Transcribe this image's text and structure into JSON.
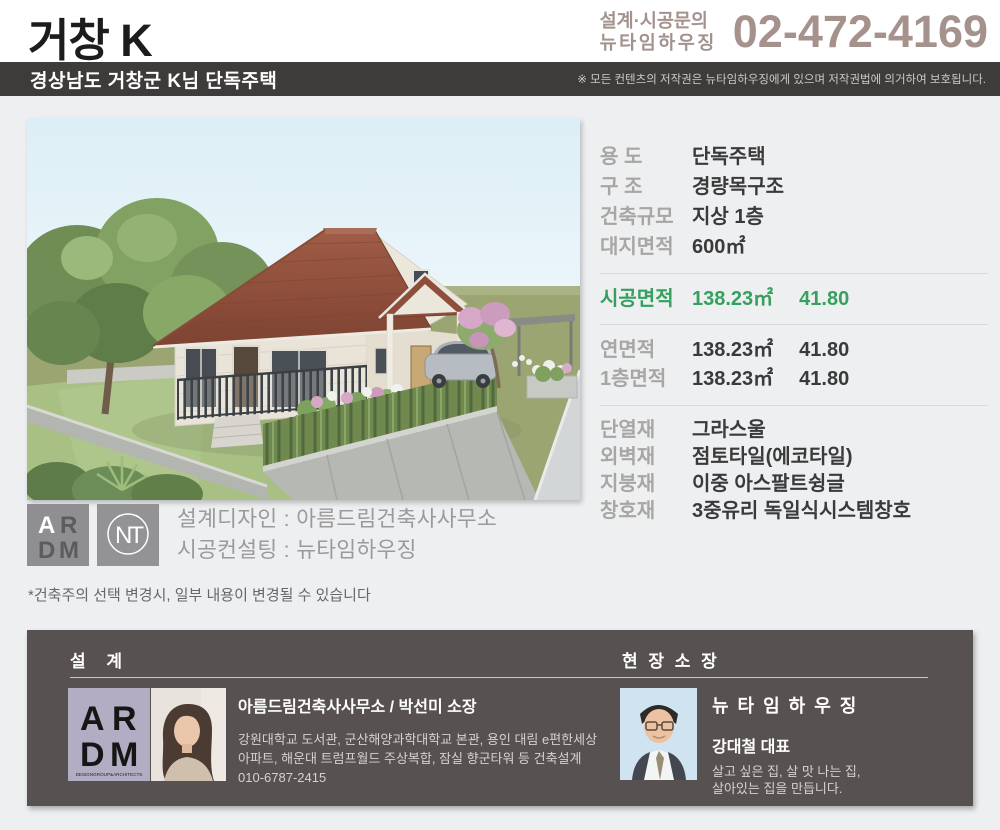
{
  "header": {
    "title": "거창 K",
    "contact_line1": "설계·시공문의",
    "contact_line2": "뉴타임하우징",
    "phone": "02-472-4169",
    "accent_color": "#a3928d"
  },
  "project_bar": {
    "title": "경상남도 거창군 K님 단독주택",
    "copyright": "※ 모든 컨텐츠의 저작권은 뉴타임하우징에게 있으며 저작권법에 의거하여 보호됩니다.",
    "bg_color": "#3e3b3b"
  },
  "specs": {
    "basic": [
      {
        "label": "용 도",
        "value": "단독주택"
      },
      {
        "label": "구 조",
        "value": "경량목구조"
      },
      {
        "label": "건축규모",
        "value": "지상 1층"
      },
      {
        "label": "대지면적",
        "value": "600㎡"
      }
    ],
    "construction": {
      "label": "시공면적",
      "value": "138.23㎡",
      "pyeong": "41.80",
      "color": "#36a05e"
    },
    "areas": [
      {
        "label": "연면적",
        "value": "138.23㎡",
        "pyeong": "41.80"
      },
      {
        "label": "1층면적",
        "value": "138.23㎡",
        "pyeong": "41.80"
      }
    ],
    "materials": [
      {
        "label": "단열재",
        "value": "그라스울"
      },
      {
        "label": "외벽재",
        "value": "점토타일(에코타일)"
      },
      {
        "label": "지붕재",
        "value": "이중 아스팔트슁글"
      },
      {
        "label": "창호재",
        "value": "3중유리 독일식시스템창호"
      }
    ]
  },
  "credits": {
    "design_line": "설계디자인 : 아름드림건축사사무소",
    "consulting_line": "시공컨설팅 : 뉴타임하우징",
    "note": "*건축주의 선택 변경시, 일부 내용이 변경될 수 있습니다"
  },
  "logos": {
    "adm_top_left": "A",
    "adm_top_right": "R",
    "adm_bottom_left": "D",
    "adm_bottom_right": "M",
    "nt_monogram": "NT"
  },
  "footer": {
    "design_section": {
      "heading": "설 계",
      "firm": "아름드림건축사사무소 / 박선미 소장",
      "desc_line1": "강원대학교 도서관, 군산해양과학대학교 본관, 용인 대림 e편한세상",
      "desc_line2": "아파트, 해운대 트럼프월드 주상복합, 잠실 향군타워 등 건축설계",
      "phone": "010-6787-2415",
      "logo_caption": "DESIGNGROUP&ARCHITECTS"
    },
    "site_manager_section": {
      "heading": "현 장 소 장",
      "company": "뉴 타 임 하 우 징",
      "name": "강대철 대표",
      "slogan_line1": "살고 싶은 집, 살 맛 나는 집,",
      "slogan_line2": "살아있는 집을 만듭니다."
    }
  }
}
